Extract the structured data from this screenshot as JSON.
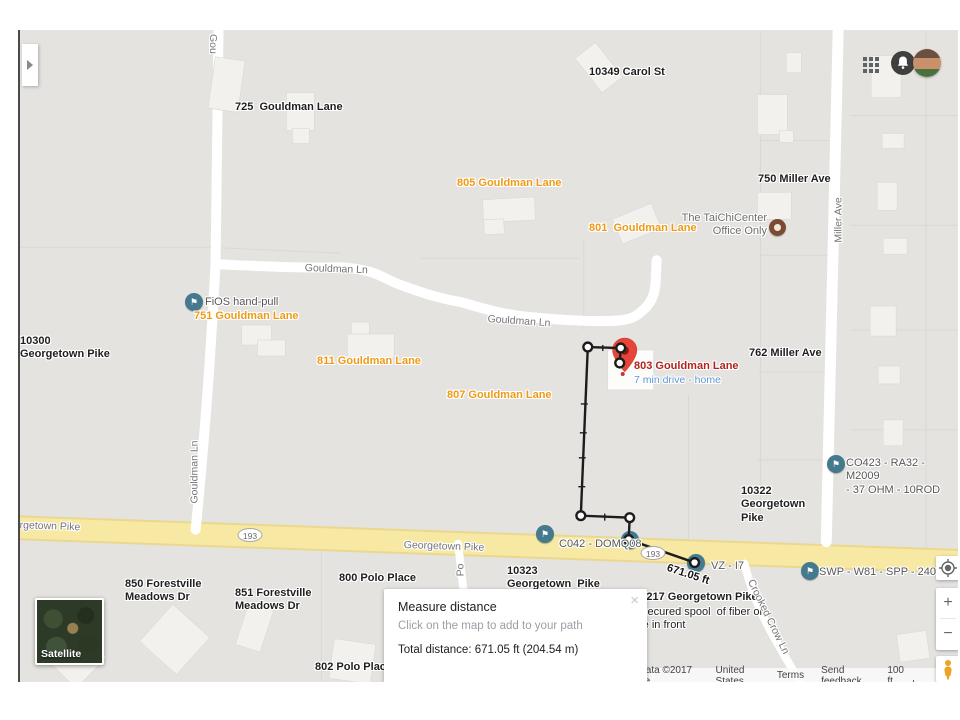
{
  "dialog": {
    "title": "Measure distance",
    "hint": "Click on the map to add to your path",
    "total": "Total distance: 671.05 ft (204.54 m)",
    "close": "×"
  },
  "controls": {
    "zoom_in": "+",
    "zoom_out": "−",
    "icons": [
      "my-location-icon",
      "pegman-icon",
      "apps-grid-icon",
      "notifications-bell-icon",
      "user-avatar",
      "expand-panel-arrow-icon"
    ]
  },
  "map": {
    "satellite_label": "Satellite",
    "colors": {
      "background": "#e5e3e0",
      "highway": "#f7e8a4",
      "road": "#ffffff",
      "label_orange": "#ef9a15",
      "label_red": "#b2241c",
      "label_blue": "#5f96d8",
      "flag_marker": "#44798e",
      "poi_marker": "#7a4a33",
      "pin_red": "#e8453a"
    },
    "labels": [
      {
        "text": "10349 Carol St",
        "x": 569,
        "y": 36,
        "type": "ab",
        "name": "label-10349-carol-st"
      },
      {
        "text": "725  Gouldman Lane",
        "x": 215,
        "y": 71,
        "type": "ab",
        "name": "label-725-gouldman"
      },
      {
        "text": "750 Miller Ave",
        "x": 738,
        "y": 143,
        "type": "ab",
        "name": "label-750-miller"
      },
      {
        "text": "762 Miller Ave",
        "x": 729,
        "y": 317,
        "type": "ab",
        "name": "label-762-miller"
      },
      {
        "text": "10300\nGeorgetown Pike",
        "x": 0,
        "y": 305,
        "type": "ab",
        "name": "label-10300-georgetown"
      },
      {
        "text": "10322\nGeorgetown\nPike",
        "x": 721,
        "y": 455,
        "type": "ab",
        "name": "label-10322-georgetown"
      },
      {
        "text": "10323\nGeorgetown  Pike",
        "x": 487,
        "y": 535,
        "type": "ab",
        "name": "label-10323-georgetown"
      },
      {
        "text": "850 Forestville\nMeadows Dr",
        "x": 105,
        "y": 548,
        "type": "ab",
        "name": "label-850-forestville"
      },
      {
        "text": "851 Forestville\nMeadows Dr",
        "x": 215,
        "y": 557,
        "type": "ab",
        "name": "label-851-forestville"
      },
      {
        "text": "800 Polo Place",
        "x": 319,
        "y": 542,
        "type": "ab",
        "name": "label-800-polo"
      },
      {
        "text": "802 Polo Place",
        "x": 295,
        "y": 631,
        "type": "ab",
        "name": "label-802-polo"
      },
      {
        "text": "801 Polo Place",
        "x": 490,
        "y": 632,
        "type": "ab",
        "name": "label-801-polo"
      },
      {
        "text": "103217 Georgetown Pike",
        "x": 608,
        "y": 561,
        "type": "ab",
        "name": "label-103217-georgetown"
      },
      {
        "text": "Unsecured spool  of fiber on\npole in front",
        "x": 608,
        "y": 576,
        "type": "nb",
        "name": "note-unsecured-spool"
      },
      {
        "text": "805 Gouldman Lane",
        "x": 437,
        "y": 147,
        "type": "ao",
        "name": "label-805-gouldman"
      },
      {
        "text": "801  Gouldman Lane",
        "x": 569,
        "y": 192,
        "type": "ao",
        "name": "label-801-gouldman"
      },
      {
        "text": "751 Gouldman Lane",
        "x": 174,
        "y": 280,
        "type": "ao",
        "name": "label-751-gouldman"
      },
      {
        "text": "811 Gouldman Lane",
        "x": 297,
        "y": 325,
        "type": "ao",
        "name": "label-811-gouldman"
      },
      {
        "text": "807 Gouldman Lane",
        "x": 427,
        "y": 359,
        "type": "ao",
        "name": "label-807-gouldman"
      },
      {
        "text": "803 Gouldman Lane",
        "x": 614,
        "y": 330,
        "type": "ar",
        "name": "label-803-gouldman"
      },
      {
        "text": "7 min drive - home",
        "x": 614,
        "y": 344,
        "type": "sb",
        "name": "label-drive-time"
      },
      {
        "text": "FiOS hand-pull",
        "x": 185,
        "y": 266,
        "type": "gn",
        "name": "note-fios-hand-pull"
      },
      {
        "text": "CO423 - RA32 - M2009\n- 37 OHM - 10ROD",
        "x": 826,
        "y": 427,
        "type": "gn",
        "name": "note-co423"
      },
      {
        "text": "C042 - DOMQ08",
        "x": 539,
        "y": 508,
        "type": "gn",
        "name": "note-c042"
      },
      {
        "text": "VZ - I7",
        "x": 691,
        "y": 530,
        "type": "gn",
        "name": "note-vz-i7"
      },
      {
        "text": "SWP - W81 - SPP - 240",
        "x": 799,
        "y": 536,
        "type": "gn",
        "name": "note-swp-w81"
      },
      {
        "text": "The TaiChiCenter\nOffice Only",
        "x": 645,
        "y": 182,
        "type": "poi",
        "w": 102,
        "ta": "right",
        "name": "poi-taichi-center"
      },
      {
        "text": "Gou",
        "x": 199,
        "y": 4,
        "type": "rd",
        "rot": 90,
        "name": "road-gouldman-top"
      },
      {
        "text": "Gouldman Ln",
        "x": 285,
        "y": 232,
        "type": "rd",
        "rot": 2,
        "name": "road-gouldman-1"
      },
      {
        "text": "Gouldman Ln",
        "x": 468,
        "y": 283,
        "type": "rd",
        "rot": 4,
        "name": "road-gouldman-2"
      },
      {
        "text": "Gouldman Ln",
        "x": 175,
        "y": 442,
        "type": "rd",
        "rot": -90,
        "c": 1,
        "name": "road-gouldman-vert"
      },
      {
        "text": "Miller Ave",
        "x": 819,
        "y": 190,
        "type": "rd",
        "rot": -90,
        "c": 1,
        "name": "road-miller-ave"
      },
      {
        "text": "Po",
        "x": 441,
        "y": 540,
        "type": "rd",
        "rot": -90,
        "c": 1,
        "name": "road-polo"
      },
      {
        "text": "orgetown Pike",
        "x": -6,
        "y": 489,
        "type": "rd",
        "rot": 2,
        "name": "road-georgetown-left"
      },
      {
        "text": "Georgetown Pike",
        "x": 384,
        "y": 509,
        "type": "rd",
        "rot": 2,
        "name": "road-georgetown-mid"
      },
      {
        "text": "Crooked Crow Ln",
        "x": 748,
        "y": 587,
        "type": "rd",
        "rot": 64,
        "c": 1,
        "name": "road-crooked-crow"
      },
      {
        "text": "671.05 ft",
        "x": 649,
        "y": 532,
        "type": "dist",
        "rot": 18,
        "name": "measure-distance-label"
      }
    ],
    "markers": [
      {
        "kind": "flag",
        "x": 174,
        "y": 272,
        "name": "flag-marker-fios"
      },
      {
        "kind": "flag",
        "x": 816,
        "y": 434,
        "name": "flag-marker-co423"
      },
      {
        "kind": "flag",
        "x": 525,
        "y": 504,
        "name": "flag-marker-c042"
      },
      {
        "kind": "flag",
        "x": 610,
        "y": 510,
        "name": "flag-marker-c042-node"
      },
      {
        "kind": "flag",
        "x": 676,
        "y": 533,
        "name": "flag-marker-vz-i7"
      },
      {
        "kind": "flag",
        "x": 790,
        "y": 541,
        "name": "flag-marker-swp"
      },
      {
        "kind": "poi",
        "x": 757,
        "y": 197,
        "name": "poi-marker-taichi"
      }
    ],
    "flag_glyph": "⚑",
    "shields": [
      {
        "text": "193",
        "x": 230,
        "y": 505
      },
      {
        "text": "193",
        "x": 633,
        "y": 523
      }
    ]
  },
  "attribution": {
    "items": [
      {
        "text": "Map data ©2017 Google",
        "link": false
      },
      {
        "text": "United States",
        "link": false
      },
      {
        "text": "Terms",
        "link": true
      },
      {
        "text": "Send feedback",
        "link": true
      }
    ],
    "scale": "100 ft"
  }
}
